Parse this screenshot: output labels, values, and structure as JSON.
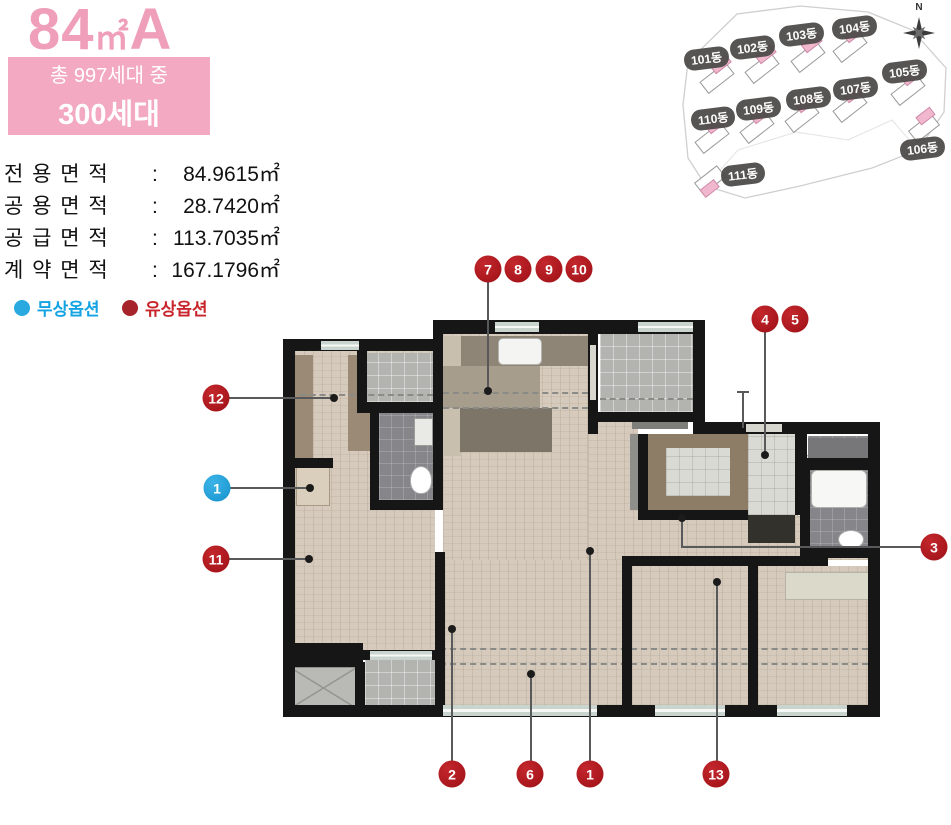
{
  "header": {
    "title": {
      "num": "84",
      "unit": "㎡",
      "suffix": "A"
    },
    "badge": {
      "line1": "총 997세대 중",
      "line2": "300세대"
    },
    "areas": [
      {
        "label": "전용면적",
        "colon": ":",
        "value": "84.9615㎡"
      },
      {
        "label": "공용면적",
        "colon": ":",
        "value": "28.7420㎡"
      },
      {
        "label": "공급면적",
        "colon": ":",
        "value": "113.7035㎡"
      },
      {
        "label": "계약면적",
        "colon": ":",
        "value": "167.1796㎡"
      }
    ],
    "legend": [
      {
        "label": "무상옵션",
        "color": "#13a3e3"
      },
      {
        "label": "유상옵션",
        "color": "#c9252c"
      }
    ]
  },
  "colors": {
    "title_pink": "#ef9fba",
    "badge_pink": "#f2a9c1",
    "paid_red": "#b21f26",
    "free_blue": "#29a9e0",
    "wall_black": "#161616"
  },
  "site_map": {
    "compass_label": "N",
    "buildings": [
      "101동",
      "102동",
      "103동",
      "104동",
      "105동",
      "106동",
      "107동",
      "108동",
      "109동",
      "110동",
      "111동"
    ]
  },
  "plan": {
    "rooms": [
      {
        "label": "실외기실"
      },
      {
        "label": "주방/식당"
      },
      {
        "label": "발코니2"
      },
      {
        "label": "드레스룸"
      },
      {
        "label": "욕실1"
      },
      {
        "label": "현관창고"
      },
      {
        "label": "현관"
      },
      {
        "label": "욕실2"
      },
      {
        "label": "침실1"
      },
      {
        "label": "거실"
      },
      {
        "label": "침실2"
      },
      {
        "label": "침실3"
      },
      {
        "label": "하향식\n피난구"
      },
      {
        "label": "발코니1"
      }
    ],
    "markers": [
      {
        "label": "7",
        "type": "paid"
      },
      {
        "label": "8",
        "type": "paid"
      },
      {
        "label": "9",
        "type": "paid"
      },
      {
        "label": "10",
        "type": "paid"
      },
      {
        "label": "4",
        "type": "paid"
      },
      {
        "label": "5",
        "type": "paid"
      },
      {
        "label": "12",
        "type": "paid"
      },
      {
        "label": "1",
        "type": "free"
      },
      {
        "label": "11",
        "type": "paid"
      },
      {
        "label": "3",
        "type": "paid"
      },
      {
        "label": "2",
        "type": "paid"
      },
      {
        "label": "6",
        "type": "paid"
      },
      {
        "label": "1",
        "type": "paid"
      },
      {
        "label": "13",
        "type": "paid"
      }
    ]
  }
}
